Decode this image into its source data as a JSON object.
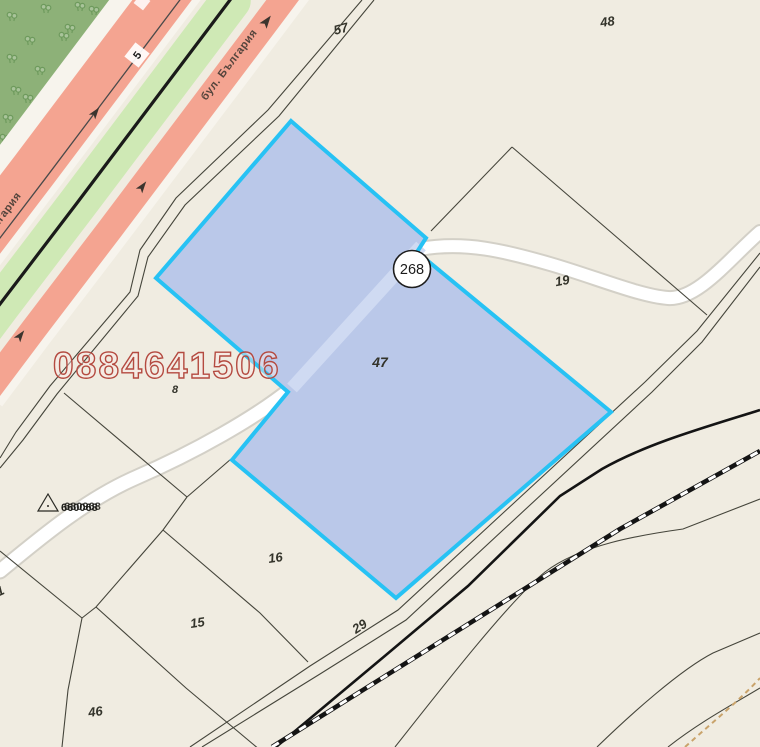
{
  "map": {
    "watermark_phone": "0884641506",
    "street_name": "бул. България",
    "street_name_partial": "бул. България",
    "route_badge_diamond": "5",
    "route_badge_circle": "268",
    "geodetic_point": {
      "label_a": "660068",
      "label_b": "680968"
    },
    "parcel_labels": [
      {
        "text": "57"
      },
      {
        "text": "48"
      },
      {
        "text": "19"
      },
      {
        "text": "47"
      },
      {
        "text": "8"
      },
      {
        "text": "16"
      },
      {
        "text": "15"
      },
      {
        "text": "46"
      },
      {
        "text": "29"
      },
      {
        "text": "1"
      }
    ],
    "colors": {
      "background": "#f0ece1",
      "park": "#8db178",
      "road_salmon": "#f4a491",
      "median_green": "#cfe9b5",
      "highlight_fill": "#bac8e9",
      "highlight_border": "#27c2f4",
      "parcel_line": "#45453b",
      "watermark_red": "#b44a40"
    }
  }
}
